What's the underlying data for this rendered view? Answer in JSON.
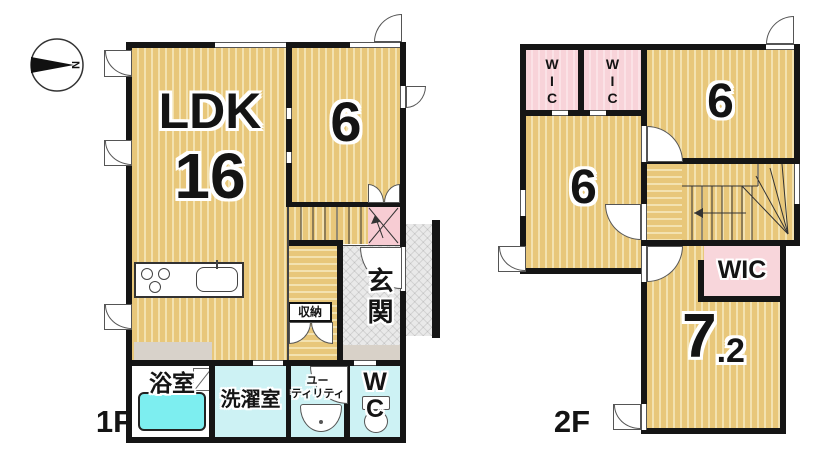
{
  "title": "floor-plan",
  "compass": {
    "north_label": "N"
  },
  "colors": {
    "floor_tan": "#e8c77a",
    "floor_stripe": "#f3e2b0",
    "closet_pink": "#f8d3d9",
    "wet_room_cyan": "#cdf2f4",
    "bathtub_cyan": "#7deef0",
    "entrance_gray": "#e9e9e9",
    "wall_black": "#151515"
  },
  "floor1": {
    "name": "1F",
    "rooms": {
      "ldk_label": "LDK",
      "ldk_size": "16",
      "bedroom_size": "6",
      "entrance": "玄関",
      "storage": "収納",
      "bathroom": "浴室",
      "laundry": "洗濯室",
      "utility_line1": "ユー",
      "utility_line2": "ティリティ",
      "wc_line1": "W",
      "wc_line2": "C"
    }
  },
  "floor2": {
    "name": "2F",
    "rooms": {
      "wic_letters": [
        "W",
        "I",
        "C"
      ],
      "bedroom_a_size": "6",
      "bedroom_b_size": "6",
      "wic_label": "WIC",
      "bedroom_c_size": "7",
      "bedroom_c_fraction": ".2"
    }
  }
}
